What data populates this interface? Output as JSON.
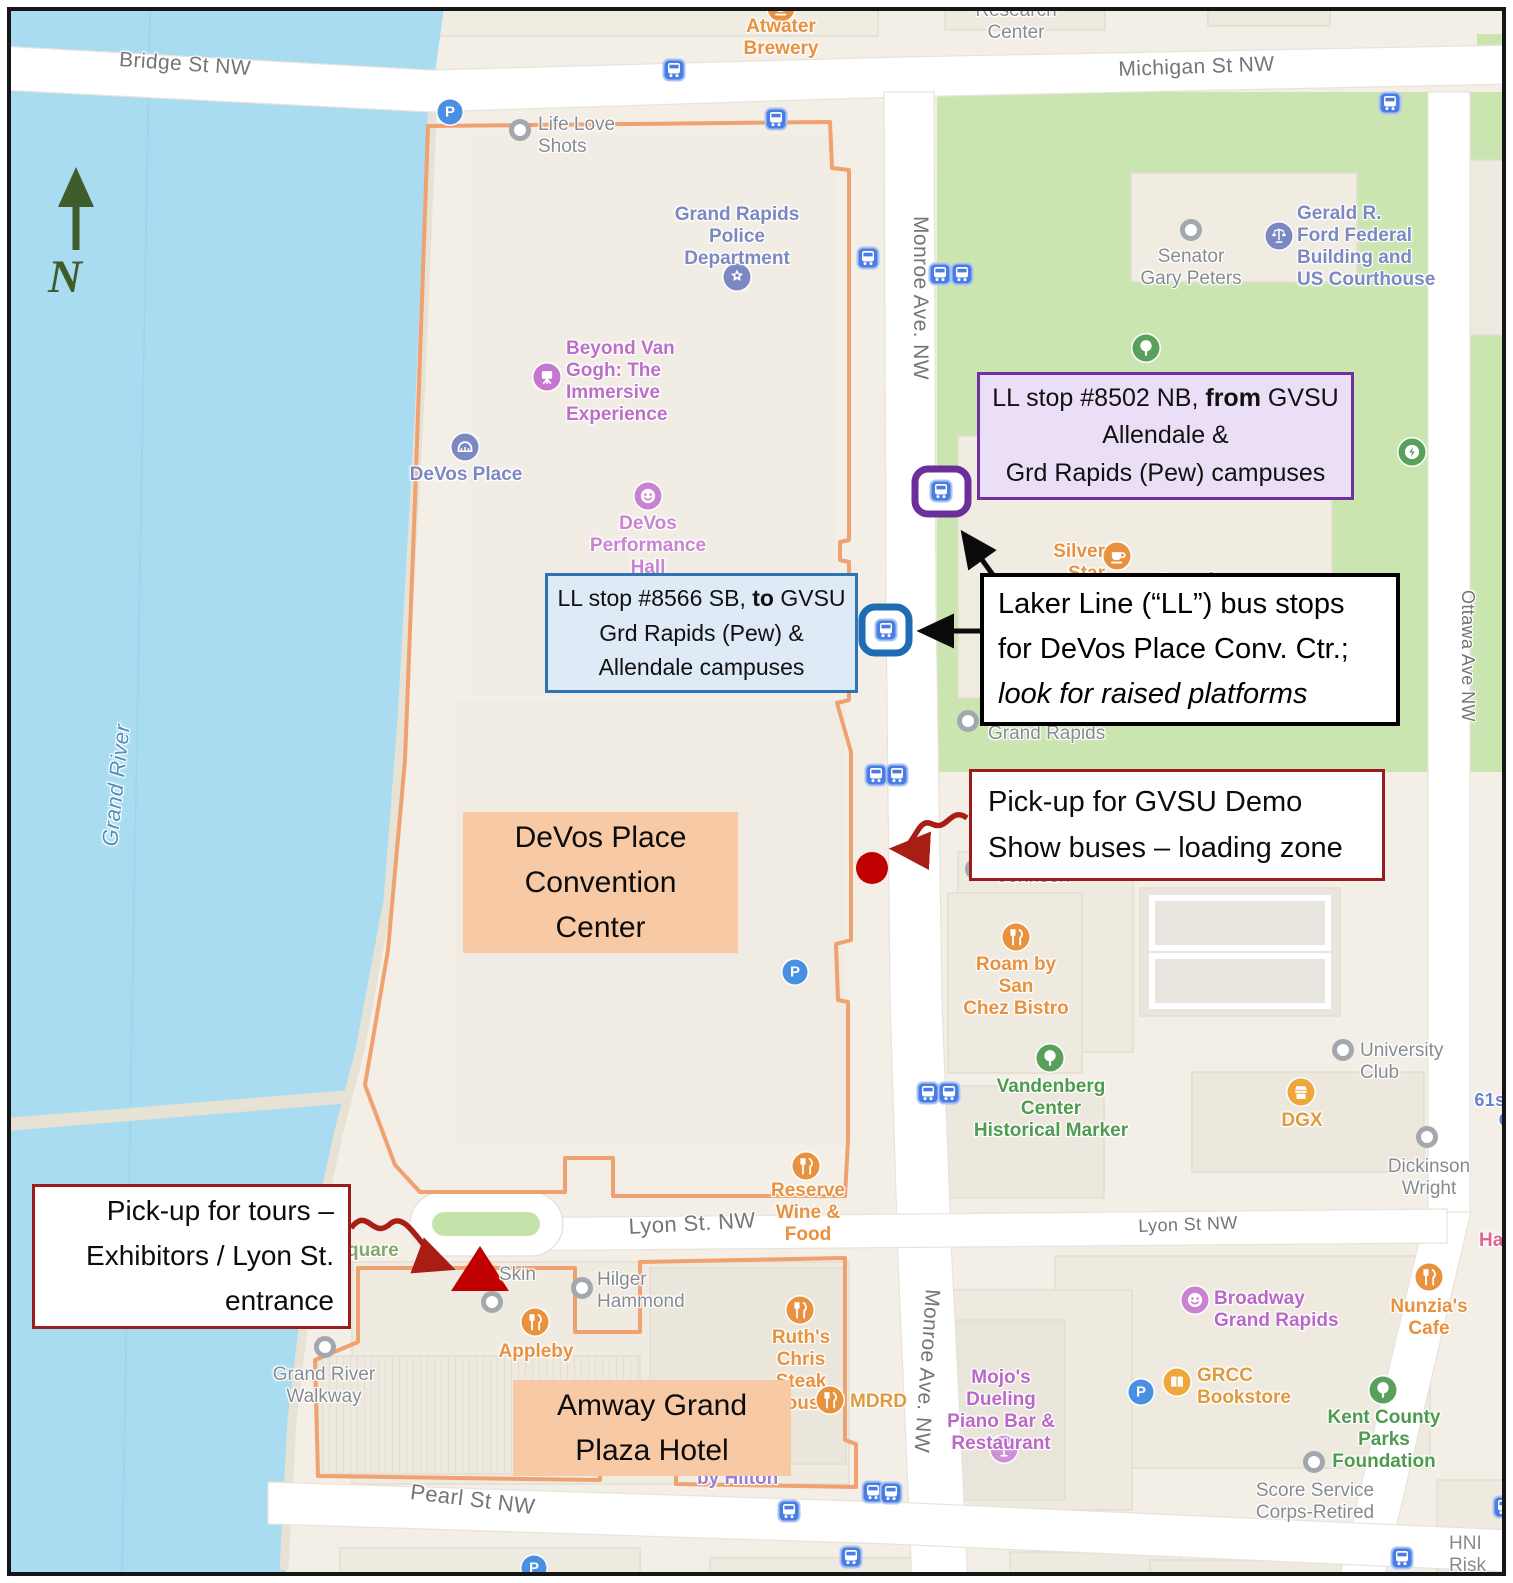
{
  "colors": {
    "water": "#A9DCF0",
    "park_green": "#CBE5B1",
    "land": "#F3EFE7",
    "road": "#FFFFFF",
    "orange_boundary": "#F0A170",
    "orange_label_bg": "#F7C9A4",
    "purple_box_border": "#7030A0",
    "purple_box_bg": "#EBDFF7",
    "blue_box_border": "#2E74B5",
    "blue_box_bg": "#DEEAF6",
    "red_box_border": "#9B1C1C",
    "annotation_red": "#C00000",
    "arrow_red": "#A81E14",
    "bus_blue": "#4A7DE4",
    "north_green": "#3F5D2A"
  },
  "north": {
    "label": "N"
  },
  "area_labels": {
    "devos": {
      "lines": [
        "DeVos Place",
        "Convention",
        "Center"
      ]
    },
    "amway": {
      "lines": [
        "Amway Grand",
        "Plaza Hotel"
      ]
    }
  },
  "annotation_boxes": {
    "ll_8502": {
      "line1_pre": "LL stop #8502 NB, ",
      "line1_bold": "from",
      "line1_post": " GVSU",
      "line2": "Allendale &",
      "line3": "Grd Rapids (Pew) campuses"
    },
    "ll_8566": {
      "line1_pre": "LL stop #8566 SB, ",
      "line1_bold": "to",
      "line1_post": " GVSU",
      "line2": "Grd Rapids (Pew) &",
      "line3": "Allendale campuses"
    },
    "laker": {
      "line1": "Laker Line (“LL”) bus stops",
      "line2": "for DeVos Place Conv. Ctr.;",
      "line3_italic": "look for raised platforms"
    },
    "demo": {
      "line1": "Pick-up for GVSU Demo",
      "line2": "Show buses – loading zone"
    },
    "tours": {
      "line1": "Pick-up for tours –",
      "line2": "Exhibitors / Lyon St.",
      "line3": "entrance"
    }
  },
  "map": {
    "parking_label": "P",
    "streets": [
      {
        "id": "bridge-st",
        "lines": [
          "Bridge St NW"
        ],
        "x": 120,
        "y": 48,
        "rot": 4,
        "size": 21
      },
      {
        "id": "michigan-st",
        "lines": [
          "Michigan St NW"
        ],
        "x": 1118,
        "y": 58,
        "rot": -2,
        "size": 21
      },
      {
        "id": "monroe-ave-top",
        "lines": [
          "Monroe Ave. NW"
        ],
        "x": 932,
        "y": 216,
        "rot": 90,
        "size": 21
      },
      {
        "id": "monroe-ave-bottom",
        "lines": [
          "Monroe Ave. NW"
        ],
        "x": 944,
        "y": 1290,
        "rot": 94,
        "size": 21
      },
      {
        "id": "ottawa-ave",
        "lines": [
          "Ottawa Ave NW"
        ],
        "x": 1478,
        "y": 590,
        "rot": 90,
        "size": 18
      },
      {
        "id": "lyon-st-left",
        "lines": [
          "Lyon St. NW"
        ],
        "x": 628,
        "y": 1215,
        "rot": -3,
        "size": 22
      },
      {
        "id": "lyon-st-right",
        "lines": [
          "Lyon St NW"
        ],
        "x": 1138,
        "y": 1216,
        "rot": -2,
        "size": 18
      },
      {
        "id": "pearl-st",
        "lines": [
          "Pearl St NW"
        ],
        "x": 412,
        "y": 1480,
        "rot": 7,
        "size": 22
      },
      {
        "id": "grand-river",
        "lines": [
          "Grand River"
        ],
        "x": 98,
        "y": 845,
        "rot": -84,
        "size": 22,
        "color": "#4E93BE",
        "italic": true
      },
      {
        "id": "61st-c",
        "lines": [
          "61st",
          "C"
        ],
        "x": 1472,
        "y": 1090,
        "size": 18,
        "color": "#6680D4",
        "w": 40,
        "align": "right",
        "weight": 600
      }
    ],
    "pois": [
      {
        "id": "atwater-brewery",
        "icon": "cafe",
        "color": "#E8913E",
        "ix": 781,
        "iy": 8,
        "label": {
          "lines": [
            "Atwater",
            "Brewery"
          ],
          "x": 722,
          "y": 16,
          "w": 118,
          "align": "center",
          "color": "#E8913E"
        }
      },
      {
        "id": "research-center",
        "label": {
          "lines": [
            "Research",
            "Center"
          ],
          "x": 962,
          "y": 0,
          "w": 108,
          "align": "center",
          "color": "#878B8F",
          "weight": 500
        }
      },
      {
        "id": "life-love-shots",
        "icon": "dot",
        "ix": 520,
        "iy": 130,
        "label": {
          "lines": [
            "Life Love",
            "Shots"
          ],
          "x": 538,
          "y": 114,
          "w": 92,
          "align": "left",
          "color": "#878B8F",
          "weight": 500
        }
      },
      {
        "id": "gr-police-dept",
        "icon": "badge",
        "color": "#7C88C2",
        "ix": 737,
        "iy": 277,
        "label": {
          "lines": [
            "Grand Rapids",
            "Police",
            "Department"
          ],
          "x": 667,
          "y": 204,
          "w": 140,
          "align": "center",
          "color": "#7C88C2"
        }
      },
      {
        "id": "beyond-van-gogh",
        "icon": "easel",
        "color": "#C477CE",
        "ix": 547,
        "iy": 377,
        "label": {
          "lines": [
            "Beyond Van",
            "Gogh: The",
            "Immersive",
            "Experience"
          ],
          "x": 566,
          "y": 338,
          "w": 128,
          "align": "left",
          "color": "#BC6FC8"
        }
      },
      {
        "id": "devos-place",
        "icon": "bridge",
        "color": "#7C88C2",
        "ix": 465,
        "iy": 447,
        "label": {
          "lines": [
            "DeVos Place"
          ],
          "x": 407,
          "y": 464,
          "w": 118,
          "align": "center",
          "color": "#7C88C2"
        }
      },
      {
        "id": "devos-performance-hall",
        "icon": "masks",
        "color": "#C983D3",
        "ix": 648,
        "iy": 496,
        "label": {
          "lines": [
            "DeVos",
            "Performance",
            "Hall"
          ],
          "x": 586,
          "y": 513,
          "w": 124,
          "align": "center",
          "color": "#C983D3"
        }
      },
      {
        "id": "senator-gary-peters",
        "icon": "dot",
        "ix": 1191,
        "iy": 230,
        "label": {
          "lines": [
            "Senator",
            "Gary Peters"
          ],
          "x": 1138,
          "y": 246,
          "w": 106,
          "align": "center",
          "color": "#878B8F",
          "weight": 500
        }
      },
      {
        "id": "ford-federal-building",
        "icon": "scales",
        "color": "#7C88C2",
        "ix": 1279,
        "iy": 236,
        "label": {
          "lines": [
            "Gerald R.",
            "Ford Federal",
            "Building and",
            "US Courthouse"
          ],
          "x": 1297,
          "y": 203,
          "w": 140,
          "align": "left",
          "color": "#7C88C2"
        }
      },
      {
        "id": "park-tree",
        "icon": "tree",
        "color": "#58A05B",
        "ix": 1146,
        "iy": 348
      },
      {
        "id": "ev-charger",
        "icon": "ev",
        "color": "#58A05B",
        "ix": 1412,
        "iy": 452
      },
      {
        "id": "silver-star-cafe",
        "icon": "cafe",
        "color": "#E8913E",
        "ix": 1117,
        "iy": 556,
        "label": {
          "lines": [
            "Silver",
            "Star Cafe"
          ],
          "x": 1023,
          "y": 541,
          "w": 82,
          "align": "right",
          "color": "#E8913E"
        }
      },
      {
        "id": "grand-rapids-city",
        "label": {
          "lines": [
            "Grand Rapids"
          ],
          "x": 1155,
          "y": 570,
          "w": 130,
          "align": "left",
          "color": "#7C8BC4",
          "size": 20
        }
      },
      {
        "id": "grand-rapids-gray",
        "icon": "dot",
        "ix": 968,
        "iy": 721,
        "label": {
          "lines": [
            "Grand Rapids"
          ],
          "x": 988,
          "y": 723,
          "w": 130,
          "align": "left",
          "color": "#878B8F",
          "weight": 500
        }
      },
      {
        "id": "johnson",
        "icon": "dot",
        "ix": 976,
        "iy": 869,
        "label": {
          "lines": [
            "Johnson"
          ],
          "x": 998,
          "y": 866,
          "w": 90,
          "align": "left",
          "color": "#878B8F",
          "weight": 500
        }
      },
      {
        "id": "roam-san-chez",
        "icon": "restaurant",
        "color": "#E8913E",
        "ix": 1016,
        "iy": 937,
        "label": {
          "lines": [
            "Roam by San",
            "Chez Bistro"
          ],
          "x": 958,
          "y": 954,
          "w": 116,
          "align": "center",
          "color": "#E8913E"
        }
      },
      {
        "id": "vandenberg-marker",
        "icon": "tree",
        "color": "#58A05B",
        "ix": 1050,
        "iy": 1058,
        "label": {
          "lines": [
            "Vandenberg Center",
            "Historical Marker"
          ],
          "x": 965,
          "y": 1076,
          "w": 172,
          "align": "center",
          "color": "#4E9A4E"
        }
      },
      {
        "id": "university-club",
        "icon": "dot",
        "ix": 1343,
        "iy": 1050,
        "label": {
          "lines": [
            "University",
            "Club"
          ],
          "x": 1360,
          "y": 1040,
          "w": 105,
          "align": "left",
          "color": "#878B8F",
          "weight": 500
        }
      },
      {
        "id": "dgx",
        "icon": "store",
        "color": "#EFA73C",
        "ix": 1301,
        "iy": 1092,
        "label": {
          "lines": [
            "DGX"
          ],
          "x": 1272,
          "y": 1110,
          "w": 60,
          "align": "center",
          "color": "#E09A3E"
        }
      },
      {
        "id": "dickinson-wright",
        "icon": "dot",
        "ix": 1427,
        "iy": 1137,
        "label": {
          "lines": [
            "Dickinson",
            "Wright"
          ],
          "x": 1385,
          "y": 1156,
          "w": 88,
          "align": "center",
          "color": "#878B8F",
          "weight": 500
        }
      },
      {
        "id": "reserve-wine-food",
        "icon": "restaurant",
        "color": "#E8913E",
        "ix": 806,
        "iy": 1166,
        "label": {
          "lines": [
            "Reserve",
            "Wine & Food"
          ],
          "x": 752,
          "y": 1180,
          "w": 112,
          "align": "center",
          "color": "#E8913E"
        }
      },
      {
        "id": "hai-partial",
        "label": {
          "lines": [
            "Hai"
          ],
          "x": 1479,
          "y": 1230,
          "w": 36,
          "align": "left",
          "color": "#E0638F"
        }
      },
      {
        "id": "skin",
        "icon": "dot",
        "ix": 492,
        "iy": 1302,
        "label": {
          "lines": [
            "Skin"
          ],
          "x": 499,
          "y": 1264,
          "w": 52,
          "align": "left",
          "color": "#878B8F",
          "weight": 500
        }
      },
      {
        "id": "hilger-hammond",
        "icon": "dot",
        "ix": 582,
        "iy": 1288,
        "label": {
          "lines": [
            "Hilger",
            "Hammond"
          ],
          "x": 597,
          "y": 1269,
          "w": 110,
          "align": "left",
          "color": "#878B8F",
          "weight": 500
        }
      },
      {
        "id": "appleby",
        "icon": "restaurant",
        "color": "#E8913E",
        "ix": 535,
        "iy": 1322,
        "label": {
          "lines": [
            "Appleby"
          ],
          "x": 496,
          "y": 1341,
          "w": 80,
          "align": "center",
          "color": "#E8913E"
        }
      },
      {
        "id": "ruths-chris",
        "icon": "restaurant",
        "color": "#E8913E",
        "ix": 800,
        "iy": 1310,
        "label": {
          "lines": [
            "Ruth's Chris",
            "Steak House"
          ],
          "x": 746,
          "y": 1327,
          "w": 110,
          "align": "center",
          "color": "#E8913E"
        }
      },
      {
        "id": "mdrd",
        "icon": "restaurant",
        "color": "#E8913E",
        "ix": 830,
        "iy": 1400,
        "label": {
          "lines": [
            "MDRD"
          ],
          "x": 850,
          "y": 1391,
          "w": 64,
          "align": "left",
          "color": "#E09A3E"
        }
      },
      {
        "id": "by-hilton",
        "label": {
          "lines": [
            "by Hilton"
          ],
          "x": 697,
          "y": 1468,
          "w": 92,
          "align": "left",
          "color": "#9B7FD1"
        }
      },
      {
        "id": "mojos-piano-bar",
        "icon": "cocktail",
        "color": "#CD90D6",
        "ix": 1004,
        "iy": 1449,
        "label": {
          "lines": [
            "Mojo's",
            "Dueling",
            "Piano Bar &",
            "Restaurant"
          ],
          "x": 945,
          "y": 1367,
          "w": 112,
          "align": "center",
          "color": "#BA68C8"
        }
      },
      {
        "id": "grcc-bookstore",
        "icon": "book",
        "color": "#EFA73C",
        "ix": 1177,
        "iy": 1382,
        "label": {
          "lines": [
            "GRCC",
            "Bookstore"
          ],
          "x": 1197,
          "y": 1365,
          "w": 110,
          "align": "left",
          "color": "#E09A3E"
        }
      },
      {
        "id": "broadway-gr",
        "icon": "masks",
        "color": "#C983D3",
        "ix": 1195,
        "iy": 1300,
        "label": {
          "lines": [
            "Broadway",
            "Grand Rapids"
          ],
          "x": 1214,
          "y": 1288,
          "w": 132,
          "align": "left",
          "color": "#BA68C8"
        }
      },
      {
        "id": "nunzias-cafe",
        "icon": "restaurant",
        "color": "#E8913E",
        "ix": 1429,
        "iy": 1277,
        "label": {
          "lines": [
            "Nunzia's Cafe"
          ],
          "x": 1369,
          "y": 1296,
          "w": 120,
          "align": "center",
          "color": "#E8913E"
        }
      },
      {
        "id": "kent-county-parks",
        "icon": "tree",
        "color": "#58A05B",
        "ix": 1383,
        "iy": 1390,
        "label": {
          "lines": [
            "Kent County",
            "Parks Foundation"
          ],
          "x": 1310,
          "y": 1407,
          "w": 148,
          "align": "center",
          "color": "#4E9A4E"
        }
      },
      {
        "id": "score-service",
        "icon": "dot",
        "ix": 1314,
        "iy": 1462,
        "label": {
          "lines": [
            "Score Service",
            "Corps-Retired"
          ],
          "x": 1252,
          "y": 1480,
          "w": 126,
          "align": "center",
          "color": "#878B8F",
          "weight": 500
        }
      },
      {
        "id": "hni-risk",
        "label": {
          "lines": [
            "HNI Risk",
            "Services"
          ],
          "x": 1449,
          "y": 1533,
          "w": 70,
          "align": "left",
          "color": "#878B8F",
          "weight": 500
        }
      },
      {
        "id": "grand-river-walkway",
        "icon": "dot",
        "ix": 325,
        "iy": 1347,
        "label": {
          "lines": [
            "Grand River",
            "Walkway"
          ],
          "x": 272,
          "y": 1364,
          "w": 104,
          "align": "center",
          "color": "#878B8F",
          "weight": 500
        }
      },
      {
        "id": "square-partial",
        "label": {
          "lines": [
            "quare"
          ],
          "x": 347,
          "y": 1240,
          "w": 70,
          "align": "left",
          "color": "#83A968"
        }
      }
    ],
    "bus_stops": [
      [
        674,
        70
      ],
      [
        776,
        119
      ],
      [
        868,
        258
      ],
      [
        940,
        274
      ],
      [
        962,
        274
      ],
      [
        1390,
        103
      ],
      [
        941,
        491
      ],
      [
        886,
        630
      ],
      [
        876,
        775
      ],
      [
        897,
        775
      ],
      [
        928,
        1093
      ],
      [
        949,
        1093
      ],
      [
        789,
        1511
      ],
      [
        873,
        1492
      ],
      [
        891,
        1493
      ],
      [
        851,
        1557
      ],
      [
        1402,
        1558
      ],
      [
        1504,
        1507
      ]
    ],
    "parking": [
      [
        450,
        112
      ],
      [
        795,
        972
      ],
      [
        1141,
        1392
      ],
      [
        534,
        1568
      ]
    ]
  }
}
